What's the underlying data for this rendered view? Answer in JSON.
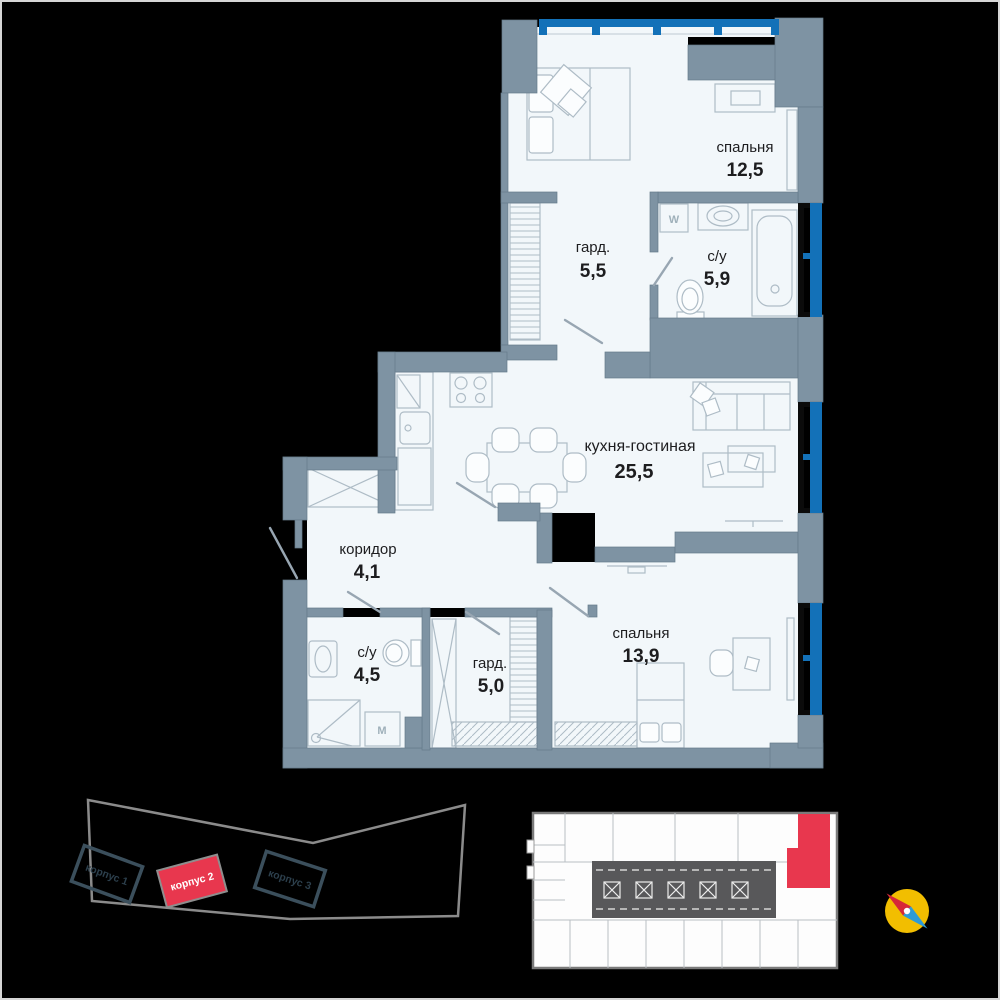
{
  "floor_plan": {
    "rooms": [
      {
        "id": "bedroom-1",
        "label": "спальня",
        "area": "12,5"
      },
      {
        "id": "wardrobe-1",
        "label": "гард.",
        "area": "5,5"
      },
      {
        "id": "bathroom-1",
        "label": "с/у",
        "area": "5,9"
      },
      {
        "id": "kitchen-living",
        "label": "кухня-гостиная",
        "area": "25,5"
      },
      {
        "id": "corridor",
        "label": "коридор",
        "area": "4,1"
      },
      {
        "id": "bathroom-2",
        "label": "с/у",
        "area": "4,5"
      },
      {
        "id": "wardrobe-2",
        "label": "гард.",
        "area": "5,0"
      },
      {
        "id": "bedroom-2",
        "label": "спальня",
        "area": "13,9"
      }
    ],
    "appliances": {
      "washer_w": "W",
      "washer_m": "M"
    }
  },
  "site_plan": {
    "buildings": [
      {
        "label": "корпус 1",
        "highlighted": false
      },
      {
        "label": "корпус 2",
        "highlighted": true
      },
      {
        "label": "корпус 3",
        "highlighted": false
      }
    ]
  },
  "floor_overview": {
    "highlighted_unit": "top-right"
  },
  "icons": {
    "compass": "compass-needle-icon"
  },
  "colors": {
    "wall": "#7E93A3",
    "floor": "#F2F7FA",
    "window_blue": "#1371B8",
    "highlight_red": "#E8374E",
    "compass_ring": "#F2BE00",
    "compass_north": "#D62839",
    "compass_south": "#2E9BD6",
    "frame": "#D6D6D6"
  }
}
